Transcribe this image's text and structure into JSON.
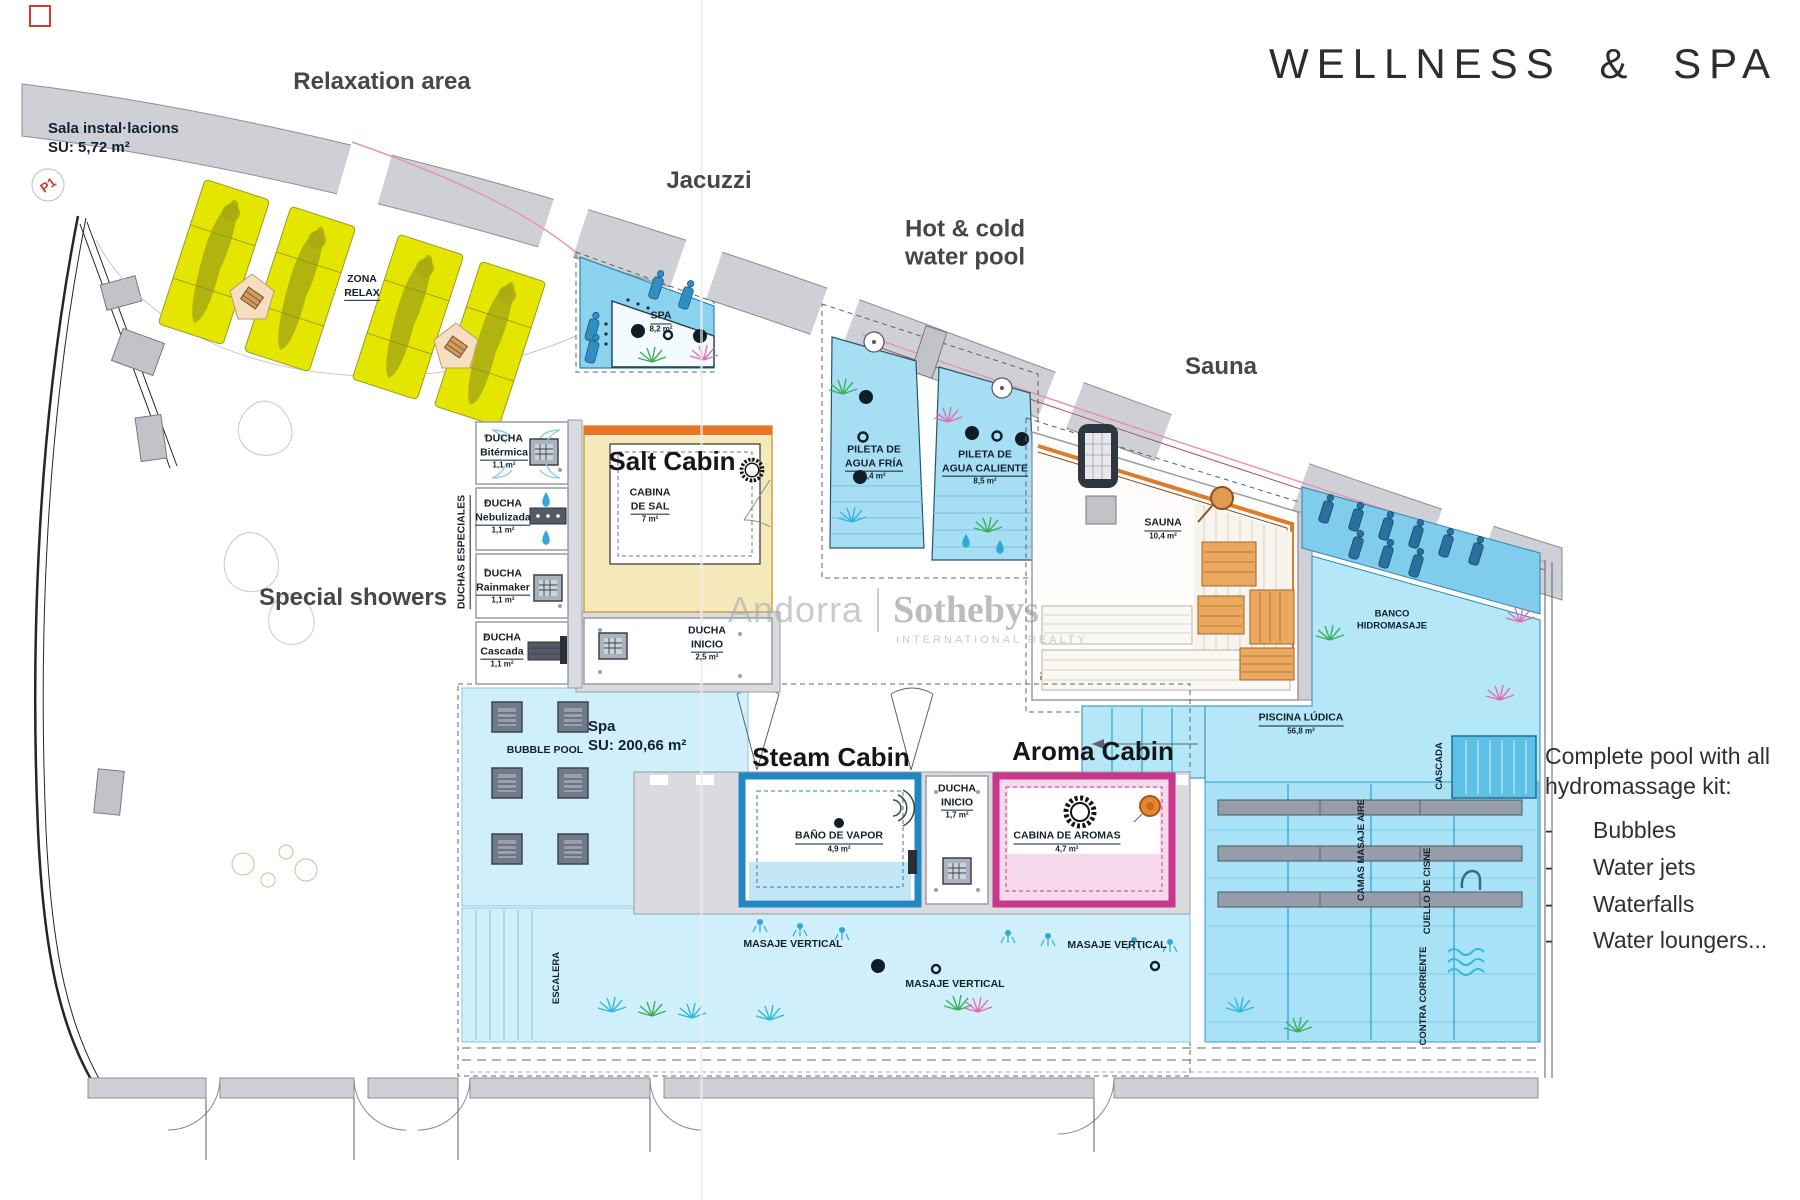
{
  "title": "WELLNESS & SPA",
  "headings": {
    "relaxation": "Relaxation area",
    "jacuzzi": "Jacuzzi",
    "hot_cold_1": "Hot & cold",
    "hot_cold_2": "water pool",
    "sauna": "Sauna",
    "salt": "Salt Cabin",
    "showers": "Special showers",
    "steam": "Steam Cabin",
    "aroma": "Aroma Cabin"
  },
  "notes": {
    "l1": "Complete pool with all",
    "l2": "hydromassage kit:",
    "dash": "-",
    "items": [
      "Bubbles",
      "Water jets",
      "Waterfalls",
      "Water loungers..."
    ]
  },
  "watermark": {
    "brand": "Andorra",
    "name": "Sothebys",
    "tag": "INTERNATIONAL REALTY"
  },
  "plan": {
    "sala": {
      "l1": "Sala instal·lacions",
      "l2": "SU: 5,72 m²"
    },
    "p1": "P1",
    "zona_relax": {
      "l1": "ZONA",
      "l2": "RELAX"
    },
    "spa": {
      "name": "SPA",
      "area": "8,2 m²"
    },
    "duchas_especiales": "DUCHAS ESPECIALES",
    "showers": [
      {
        "t": "DUCHA",
        "n": "Bitérmica",
        "a": "1,1 m²"
      },
      {
        "t": "DUCHA",
        "n": "Nebulizada",
        "a": "1,1 m²"
      },
      {
        "t": "DUCHA",
        "n": "Rainmaker",
        "a": "1,1 m²"
      },
      {
        "t": "DUCHA",
        "n": "Cascada",
        "a": "1,1 m²"
      }
    ],
    "cabina_sal": {
      "l1": "CABINA",
      "l2": "DE SAL",
      "area": "7 m²"
    },
    "ducha_inicio_top": {
      "l1": "DUCHA",
      "l2": "INICIO",
      "area": "2,5 m²"
    },
    "pileta_fria": {
      "l1": "PILETA DE",
      "l2": "AGUA FRÍA",
      "area": "5,4 m²"
    },
    "pileta_caliente": {
      "l1": "PILETA DE",
      "l2": "AGUA CALIENTE",
      "area": "8,5 m²"
    },
    "sauna": {
      "name": "SAUNA",
      "area": "10,4 m²"
    },
    "banco": {
      "l1": "BANCO",
      "l2": "HIDROMASAJE"
    },
    "piscina": {
      "name": "PISCINA LÚDICA",
      "area": "56,8 m²"
    },
    "cascada": "CASCADA",
    "camas": "CAMAS MASAJE AIRE",
    "cuello": "CUELLO DE CISNE",
    "contra": "CONTRA CORRIENTE",
    "spa_su": {
      "l1": "Spa",
      "l2": "SU: 200,66 m²"
    },
    "bubble_pool": "BUBBLE POOL",
    "bano_vapor": {
      "name": "BAÑO DE VAPOR",
      "area": "4,9 m²"
    },
    "ducha_inicio_bottom": {
      "l1": "DUCHA",
      "l2": "INICIO",
      "area": "1,7 m²"
    },
    "cabina_aromas": {
      "name": "CABINA DE AROMAS",
      "area": "4,7 m²"
    },
    "masaje_vertical": "MASAJE VERTICAL",
    "escalera": "ESCALERA"
  },
  "colors": {
    "pool_blue": "#8bd2ef",
    "pool_light": "#c9edf8",
    "lounger_yellow": "#e4e600",
    "salt_yellow": "#f5e9bb",
    "salt_orange": "#e8762a",
    "steam_blue": "#2187c4",
    "aroma_pink": "#c8378c",
    "sauna_wood": "#e9a55f",
    "wall_grey": "#cfd0d6",
    "label_navy": "#15202c"
  }
}
